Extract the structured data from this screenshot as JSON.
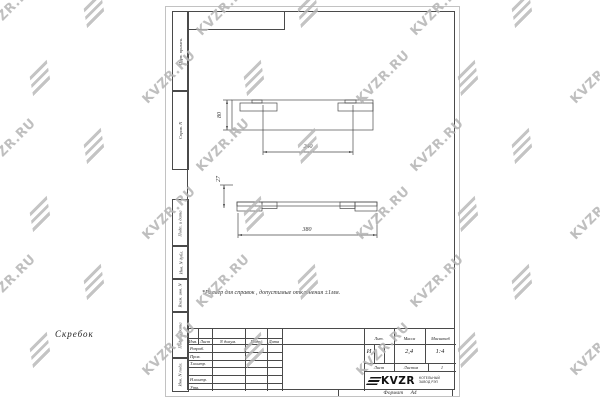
{
  "watermark": {
    "text": "KVZR.RU"
  },
  "sheet": {
    "format_label": "Формат А4",
    "side_columns_top": [
      "Перв. примен.",
      "Справ. N"
    ],
    "side_columns_bottom": [
      "Подп. и дата",
      "Инв. N дубл.",
      "Взам. инв. N",
      "Подп. и дата",
      "Инв. N подл."
    ]
  },
  "drawing": {
    "note": "*Размер для справок , допустимые отклонения ±1мм.",
    "top_view": {
      "height_dim": "80",
      "length_dim": "240"
    },
    "front_view": {
      "height_dim": "27",
      "length_dim": "380"
    }
  },
  "title_block": {
    "change_header": [
      "Изм.",
      "Лист",
      "N докум.",
      "Подп.",
      "Дата"
    ],
    "signature_rows": [
      "Разраб.",
      "Пров.",
      "Т.контр.",
      "",
      "Н.контр.",
      "Утв."
    ],
    "title": "Скребок",
    "lit_label": "Лит.",
    "mass_label": "Масса",
    "scale_label": "Масштаб",
    "lit_value": "И",
    "mass_value": "2,4",
    "scale_value": "1:4",
    "sheet_label": "Лист",
    "sheets_label": "Листов",
    "sheets_value": "1",
    "company_name": "KVZR",
    "company_line1": "КОТЕЛЬНЫЙ",
    "company_line2": "ЗАВОД РЭП"
  }
}
